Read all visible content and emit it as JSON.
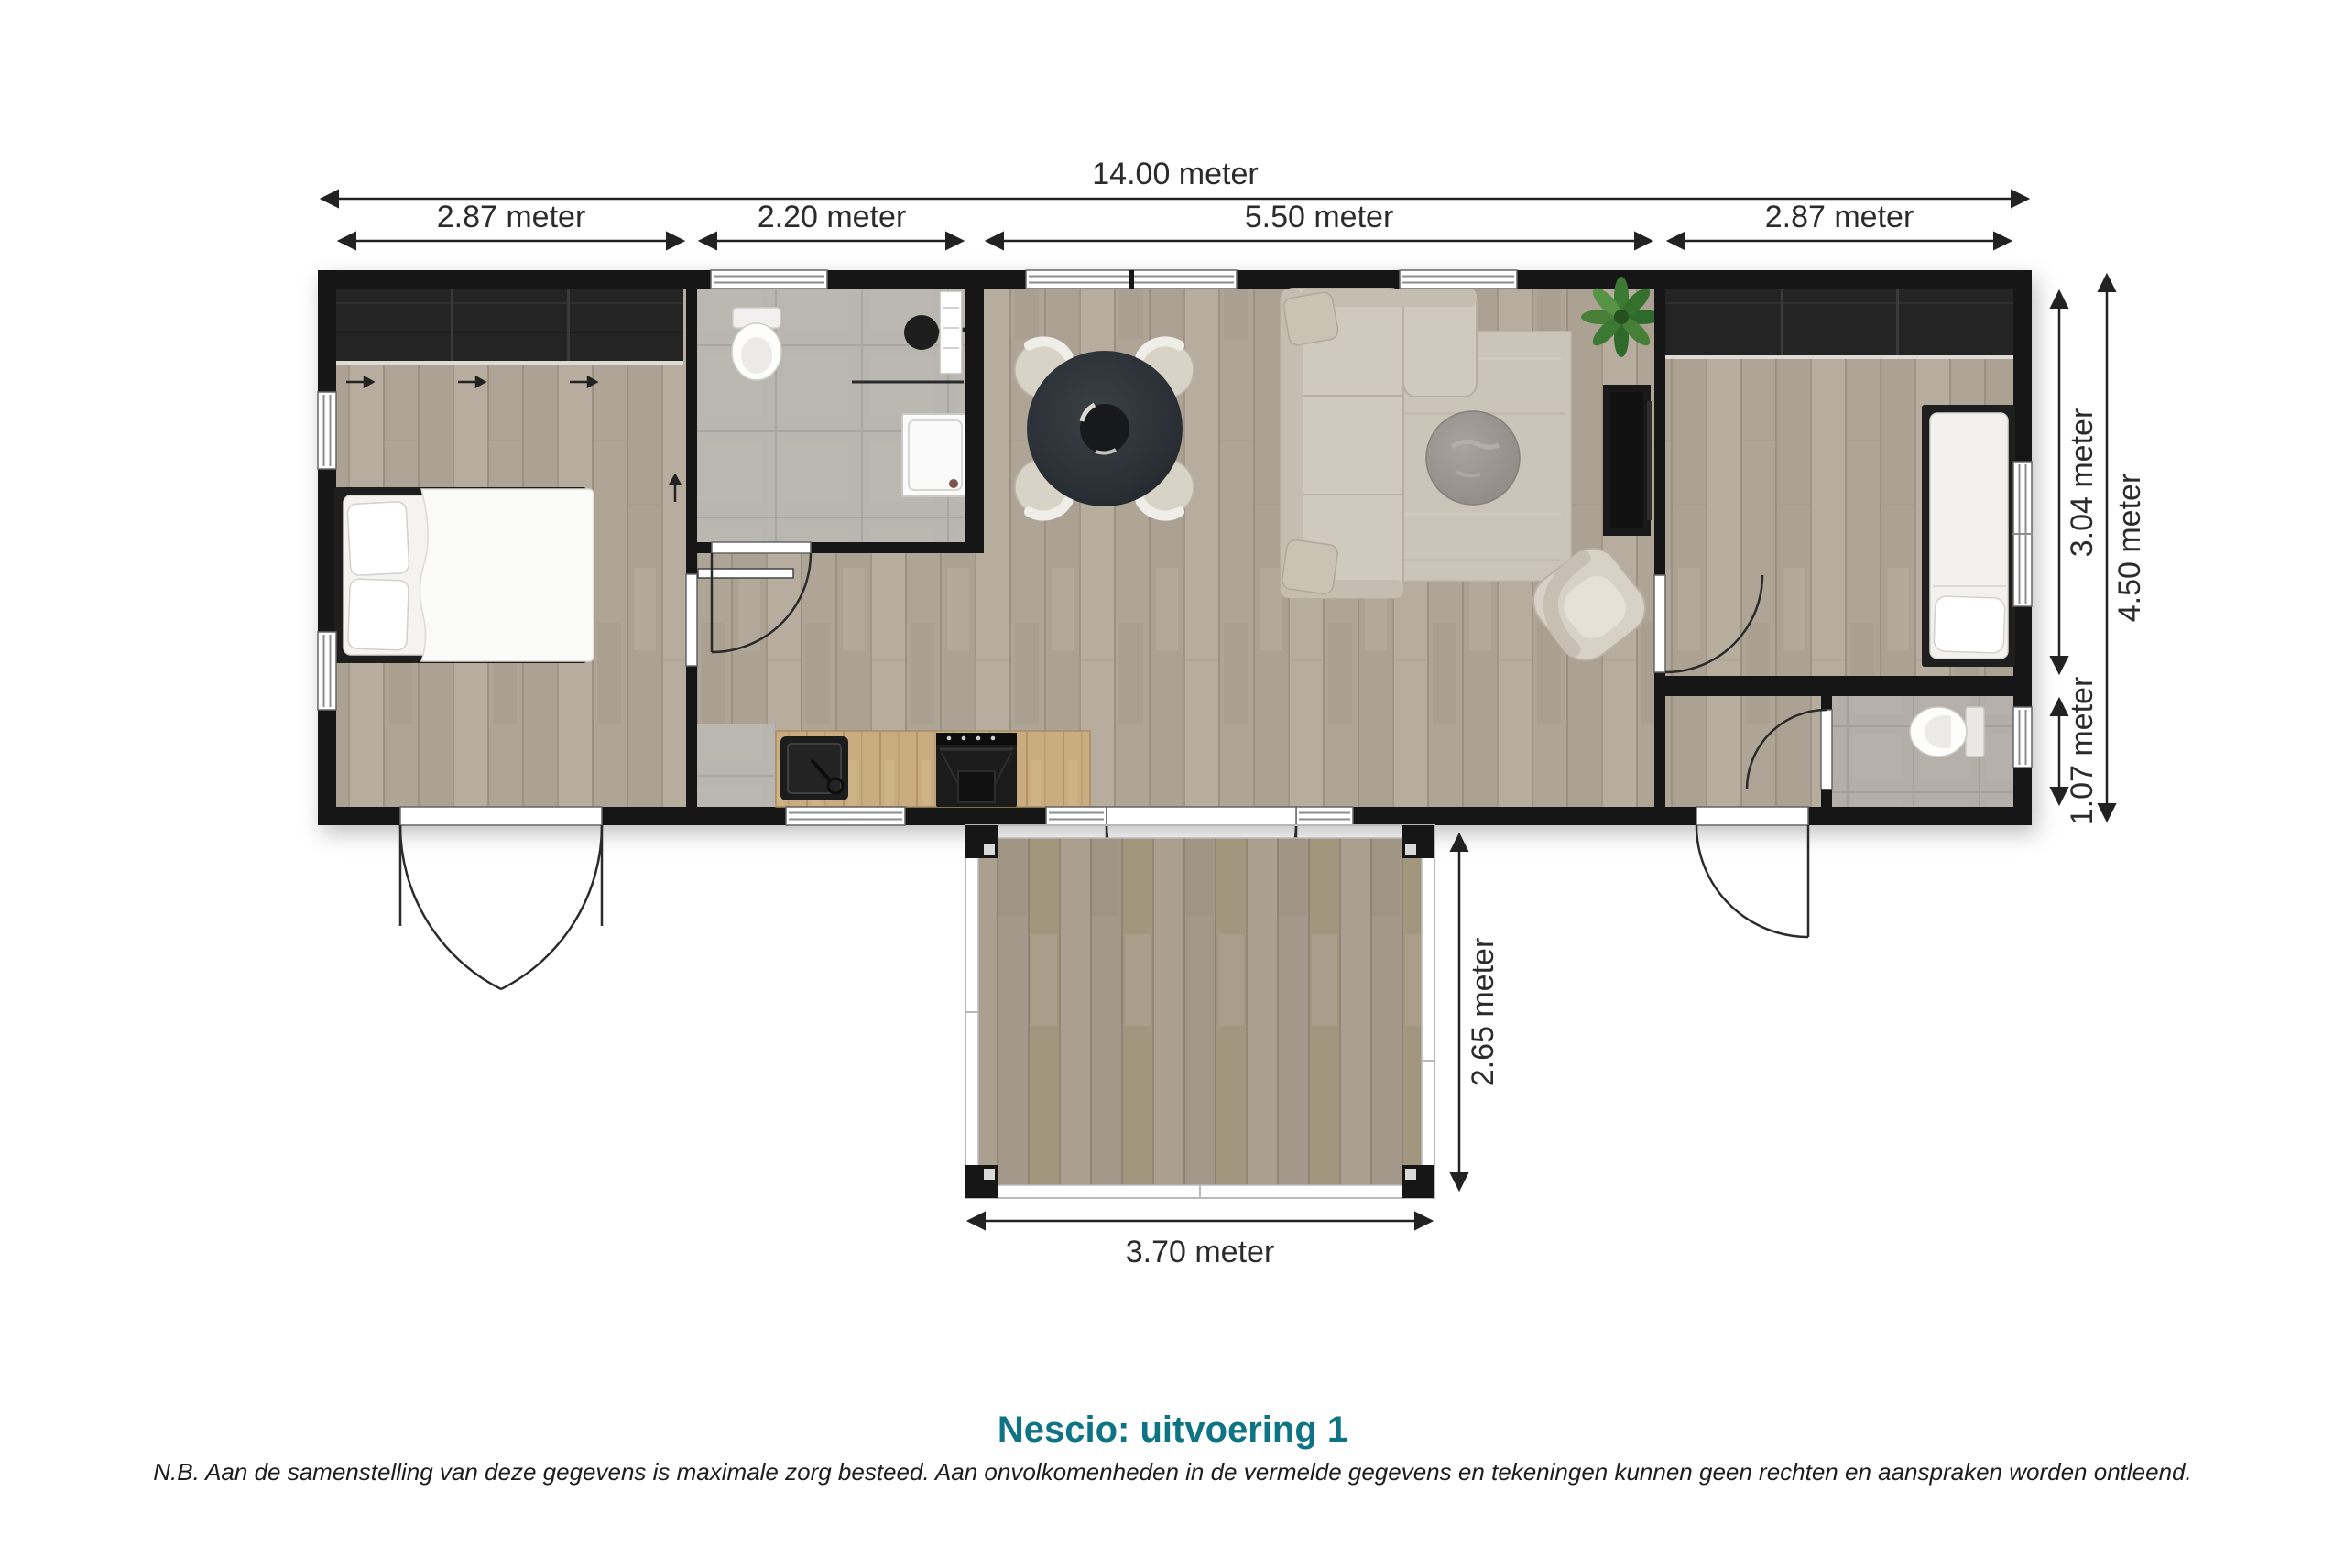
{
  "title": {
    "text": "Nescio: uitvoering 1",
    "color": "#0e7383"
  },
  "disclaimer": "N.B. Aan de samenstelling van deze gegevens is maximale zorg besteed. Aan onvolkomenheden in de vermelde gegevens en tekeningen kunnen geen rechten en aanspraken worden ontleend.",
  "dimensions": {
    "unit": "meter",
    "total_width": "14.00 meter",
    "segments": [
      {
        "label": "2.87 meter"
      },
      {
        "label": "2.20 meter"
      },
      {
        "label": "5.50 meter"
      },
      {
        "label": "2.87 meter"
      }
    ],
    "right_bedroom": "3.04 meter",
    "right_wc": "1.07 meter",
    "right_total": "4.50 meter",
    "terrace_depth": "2.65 meter",
    "terrace_width": "3.70 meter"
  },
  "colors": {
    "accent": "#0e7383",
    "walls": "#161616",
    "wood_floor": "#b2a89b",
    "terrace_deck": "#a89c8c",
    "bathroom_tile": "#b9b6b1",
    "dimension_text": "#2b2b2b"
  }
}
